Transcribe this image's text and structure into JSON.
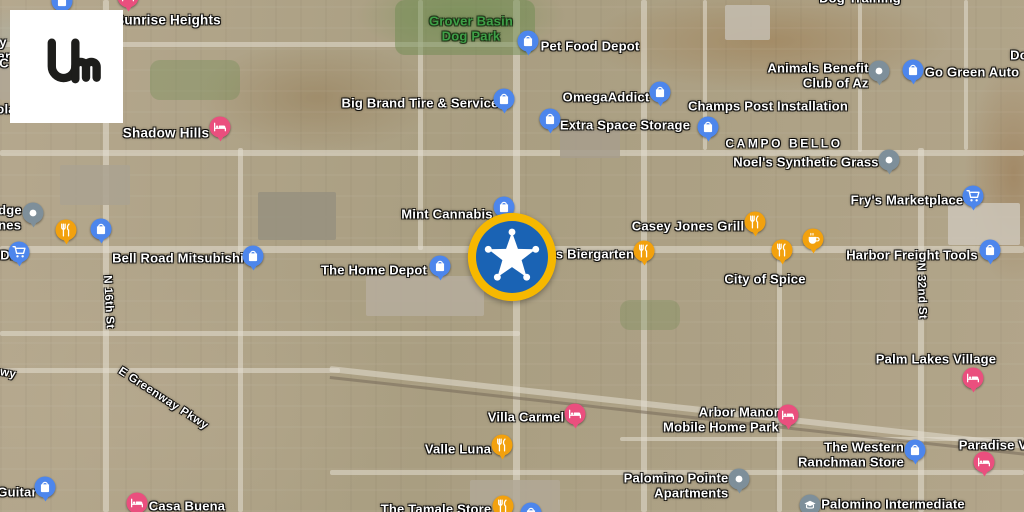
{
  "logo": {
    "name": "liveuamap",
    "text": "Um"
  },
  "colors": {
    "pin_blue": "#4d86ec",
    "pin_orange": "#f2a10e",
    "pin_pink": "#ea4f7e",
    "pin_gray": "#7e8f9a",
    "event_ring": "#f6b800",
    "event_fill": "#1a63b4",
    "park_label": "#3fa047"
  },
  "event": {
    "icon": "sheriff-star",
    "x": 512,
    "y": 257,
    "title": "police event marker"
  },
  "labels": [
    {
      "text": "Sunrise Heights",
      "x": 168,
      "y": 20,
      "type": "neighborhood"
    },
    {
      "text": "Dog Training",
      "x": 860,
      "y": -1,
      "type": "poi"
    },
    {
      "text": "Do",
      "x": 1019,
      "y": 56,
      "type": "poi",
      "align": "left"
    },
    {
      "lines": [
        "Grover Basin",
        "Dog Park"
      ],
      "x": 471,
      "y": 29,
      "type": "park"
    },
    {
      "text": "Pet Food Depot",
      "x": 590,
      "y": 47,
      "type": "poi"
    },
    {
      "text": "Big Brand Tire & Service",
      "x": 420,
      "y": 104,
      "type": "poi"
    },
    {
      "text": "OmegaAddict",
      "x": 606,
      "y": 98,
      "type": "poi"
    },
    {
      "text": "Extra Space Storage",
      "x": 625,
      "y": 126,
      "type": "poi"
    },
    {
      "text": "Champs Post Installation",
      "x": 768,
      "y": 107,
      "type": "poi"
    },
    {
      "lines": [
        "Animals Benefit",
        "Club of Az"
      ],
      "x": 818,
      "y": 76,
      "type": "poi",
      "align": "right"
    },
    {
      "text": "Go Green Auto",
      "x": 972,
      "y": 73,
      "type": "poi"
    },
    {
      "text": "CAMPO BELLO",
      "x": 784,
      "y": 144,
      "type": "district"
    },
    {
      "text": "Noel's Synthetic Grass",
      "x": 806,
      "y": 163,
      "type": "poi"
    },
    {
      "text": "Shadow Hills",
      "x": 166,
      "y": 133,
      "type": "neighborhood"
    },
    {
      "text": "Fry's Marketplace",
      "x": 907,
      "y": 201,
      "type": "poi"
    },
    {
      "lines": [
        "dge",
        "nes"
      ],
      "x": 10,
      "y": 218,
      "type": "poi",
      "align": "left"
    },
    {
      "text": "DI",
      "x": 7,
      "y": 256,
      "type": "poi",
      "align": "left"
    },
    {
      "text": "y",
      "x": 3,
      "y": 43,
      "type": "poi",
      "align": "left"
    },
    {
      "text": "ar",
      "x": 4,
      "y": 57,
      "type": "poi",
      "align": "left"
    },
    {
      "text": "C",
      "x": 4,
      "y": 64,
      "type": "poi",
      "align": "left"
    },
    {
      "text": "ola",
      "x": 6,
      "y": 110,
      "type": "poi",
      "align": "left"
    },
    {
      "text": "Mint Cannabis",
      "x": 447,
      "y": 215,
      "type": "poi"
    },
    {
      "text": "Bell Road Mitsubishi",
      "x": 178,
      "y": 259,
      "type": "poi"
    },
    {
      "text": "The Home Depot",
      "x": 374,
      "y": 271,
      "type": "poi"
    },
    {
      "text": "s Biergarten",
      "x": 595,
      "y": 255,
      "type": "poi"
    },
    {
      "text": "Casey Jones Grill",
      "x": 688,
      "y": 227,
      "type": "poi"
    },
    {
      "text": "City of Spice",
      "x": 765,
      "y": 280,
      "type": "poi"
    },
    {
      "text": "Harbor Freight Tools",
      "x": 912,
      "y": 256,
      "type": "poi"
    },
    {
      "text": "N 16th St",
      "x": 108,
      "y": 302,
      "type": "street",
      "rotate": 87
    },
    {
      "text": "N 32nd St",
      "x": 921,
      "y": 291,
      "type": "street",
      "rotate": 88
    },
    {
      "text": "E Greenway Pkwy",
      "x": 163,
      "y": 399,
      "type": "street",
      "rotate": 33
    },
    {
      "text": "wy",
      "x": 8,
      "y": 374,
      "type": "street",
      "rotate": 10
    },
    {
      "text": "Palm Lakes Village",
      "x": 936,
      "y": 360,
      "type": "poi"
    },
    {
      "text": "Villa Carmel",
      "x": 526,
      "y": 418,
      "type": "poi"
    },
    {
      "text": "Valle Luna",
      "x": 458,
      "y": 450,
      "type": "poi"
    },
    {
      "lines": [
        "Arbor Manor",
        "Mobile Home Park"
      ],
      "x": 721,
      "y": 420,
      "type": "poi",
      "align": "right"
    },
    {
      "lines": [
        "The Western",
        "Ranchman Store"
      ],
      "x": 851,
      "y": 455,
      "type": "poi",
      "align": "right"
    },
    {
      "text": "Paradise V",
      "x": 993,
      "y": 446,
      "type": "poi"
    },
    {
      "lines": [
        "Palomino Pointe",
        "Apartments"
      ],
      "x": 676,
      "y": 486,
      "type": "poi",
      "align": "right"
    },
    {
      "text": "Palomino Intermediate",
      "x": 893,
      "y": 505,
      "type": "poi"
    },
    {
      "text": "Guitar",
      "x": 17,
      "y": 493,
      "type": "poi"
    },
    {
      "text": "Casa Buena",
      "x": 187,
      "y": 507,
      "type": "poi"
    },
    {
      "text": "The Tamale Store",
      "x": 436,
      "y": 510,
      "type": "poi"
    }
  ],
  "markers": [
    {
      "icon": "shopping-bag",
      "color": "blue",
      "x": 62,
      "y": 1
    },
    {
      "icon": "hotel-bed",
      "color": "pink",
      "x": 128,
      "y": -3
    },
    {
      "icon": "hotel-bed",
      "color": "pink",
      "x": 220,
      "y": 127
    },
    {
      "icon": "shopping-bag",
      "color": "blue",
      "x": 504,
      "y": 99
    },
    {
      "icon": "shopping-bag",
      "color": "blue",
      "x": 528,
      "y": 41
    },
    {
      "icon": "shopping-bag",
      "color": "blue",
      "x": 660,
      "y": 92
    },
    {
      "icon": "shopping-bag",
      "color": "blue",
      "x": 550,
      "y": 119
    },
    {
      "icon": "shopping-bag",
      "color": "blue",
      "x": 708,
      "y": 127
    },
    {
      "icon": "dot",
      "color": "gray",
      "x": 879,
      "y": 71
    },
    {
      "icon": "shopping-bag",
      "color": "blue",
      "x": 913,
      "y": 70
    },
    {
      "icon": "dot",
      "color": "gray",
      "x": 889,
      "y": 160
    },
    {
      "icon": "cart",
      "color": "blue",
      "x": 973,
      "y": 196
    },
    {
      "icon": "dot",
      "color": "gray",
      "x": 33,
      "y": 213
    },
    {
      "icon": "restaurant",
      "color": "orange",
      "x": 66,
      "y": 230
    },
    {
      "icon": "shopping-bag",
      "color": "blue",
      "x": 101,
      "y": 229
    },
    {
      "icon": "cart",
      "color": "blue",
      "x": 19,
      "y": 252
    },
    {
      "icon": "shopping-bag",
      "color": "blue",
      "x": 253,
      "y": 256
    },
    {
      "icon": "shopping-bag",
      "color": "blue",
      "x": 440,
      "y": 266
    },
    {
      "icon": "shopping-bag",
      "color": "blue",
      "x": 504,
      "y": 207
    },
    {
      "icon": "restaurant",
      "color": "orange",
      "x": 644,
      "y": 251
    },
    {
      "icon": "restaurant",
      "color": "orange",
      "x": 755,
      "y": 222
    },
    {
      "icon": "coffee",
      "color": "orange",
      "x": 813,
      "y": 239
    },
    {
      "icon": "restaurant",
      "color": "orange",
      "x": 782,
      "y": 250
    },
    {
      "icon": "shopping-bag",
      "color": "blue",
      "x": 990,
      "y": 250
    },
    {
      "icon": "hotel-bed",
      "color": "pink",
      "x": 973,
      "y": 378
    },
    {
      "icon": "shopping-bag",
      "color": "blue",
      "x": 45,
      "y": 487
    },
    {
      "icon": "hotel-bed",
      "color": "pink",
      "x": 137,
      "y": 503
    },
    {
      "icon": "hotel-bed",
      "color": "pink",
      "x": 575,
      "y": 414
    },
    {
      "icon": "restaurant",
      "color": "orange",
      "x": 502,
      "y": 445
    },
    {
      "icon": "restaurant",
      "color": "orange",
      "x": 503,
      "y": 506
    },
    {
      "icon": "shopping-bag",
      "color": "blue",
      "x": 531,
      "y": 513
    },
    {
      "icon": "hotel-bed",
      "color": "pink",
      "x": 788,
      "y": 415
    },
    {
      "icon": "shopping-bag",
      "color": "blue",
      "x": 915,
      "y": 450
    },
    {
      "icon": "hotel-bed",
      "color": "pink",
      "x": 984,
      "y": 462
    },
    {
      "icon": "dot",
      "color": "gray",
      "x": 739,
      "y": 479
    },
    {
      "icon": "school-cap",
      "color": "gray",
      "x": 810,
      "y": 505
    }
  ]
}
